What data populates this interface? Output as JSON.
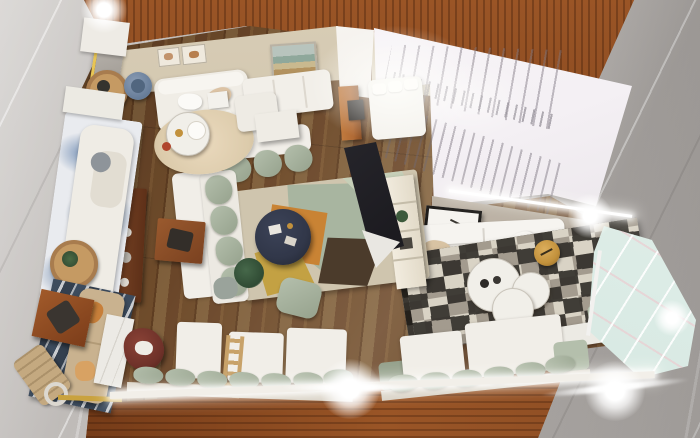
{
  "scene": {
    "title": "Top-down 3D architectural render of a furnished open-plan apartment",
    "rooms": [
      "bedroom lounge (top left)",
      "gallery lounge (top center)",
      "stair hall (top right)",
      "reading nook with chaise (left)",
      "living room with sectional sofa (center)",
      "media lounge with patchwork rug (right)",
      "terrace bench seating (bottom)"
    ],
    "objects": [
      "white staircase with slat railing",
      "frosted mint glass sliding wall",
      "mahogany perimeter wall",
      "oak plank flooring",
      "gray marble exterior floor",
      "beige bedroom wall with two framed prints",
      "landscape painting",
      "white loveseat",
      "slate-blue armchair",
      "round cream rug",
      "round white side table",
      "white dog figurine",
      "white chaise lounge on blue watercolor rug",
      "round wooden plant tables",
      "sage green modular sectional sofa",
      "geometric patch rug (orange, sage, mustard, brown)",
      "navy round coffee table",
      "white storage shelf",
      "dark flat TV panel",
      "sage ottoman",
      "potted plant",
      "walnut sideboard with decor",
      "walnut coffee table with tray",
      "white three-seat sofa with pillows",
      "black-and-white patchwork cowhide rug",
      "cluster of round white coffee tables",
      "brass stool",
      "leaning framed bird artwork",
      "tan sofa on navy striped rug",
      "walnut low table with dark cushion",
      "marble bench",
      "maroon swivel chair",
      "folded deck chair",
      "rope ring decor",
      "built-in bench with sage cushions",
      "wooden ladder rack",
      "LED strip lights with lens flares"
    ],
    "lighting": [
      "led strip along right wall",
      "led ledge light at terrace edge",
      "lens flare bottom center",
      "lens flare at glass corner",
      "bright wash over gallery lounge"
    ]
  },
  "palette": {
    "marble1": "#c6c2bf",
    "marble2": "#a9a5a1",
    "woodband1": "#8a4c24",
    "woodband2": "#6b3414",
    "woodband3": "#9a5526",
    "floor1": "#74512f",
    "floor2": "#5e3d21",
    "floor3": "#80603c",
    "wallbeige": "#cdc1a9",
    "wallbeige2": "#b3a99c",
    "white1": "#f1eee8",
    "white2": "#e4e0d8",
    "sage": "#b4bfac",
    "sagedark": "#96a28d",
    "stairwhite": "#f4f0f4",
    "stairline": "#a29aa6",
    "glass": "#d9eae4",
    "glass2": "#c8ded8",
    "navy": "#313749",
    "navyrug": "#3d4c5e",
    "rugcream": "#cfc5ae",
    "rugsage": "#a8b5a0",
    "rugorange": "#c98334",
    "rugmustard": "#c3a143",
    "rugbrown": "#4b3b2b",
    "rugpale": "#c6cfb8",
    "tan": "#c9b28f",
    "maroon": "#6e3129",
    "woodmid": "#8d4e26",
    "wooddark": "#623318",
    "cabinet": "#b06a35",
    "gold": "#c2913c",
    "ledyellow": "#e8c554",
    "blue1": "#6987af",
    "blue2": "#47688f",
    "dark": "#26242a",
    "patchdark": "#33302b",
    "patchlight": "#ddd6c8",
    "patchmid": "#968d81",
    "artsky": "#b8c4bd",
    "artsea": "#8fa89b",
    "artsand": "#c9b98f"
  }
}
